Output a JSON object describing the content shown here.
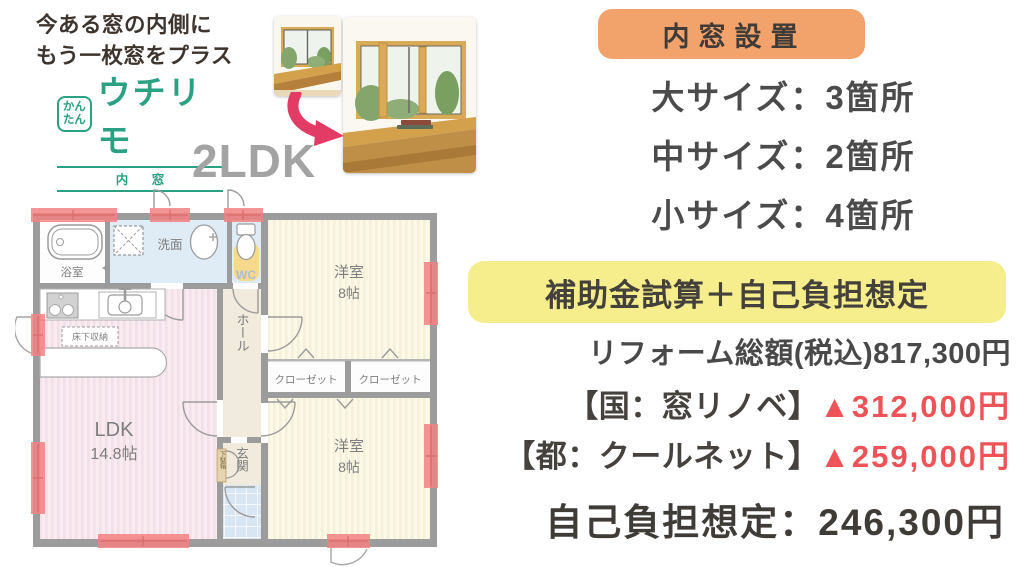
{
  "header": {
    "tagline_line1": "今ある窓の内側に",
    "tagline_line2": "もう一枚窓をプラス",
    "logo": {
      "kantan": "かんたん",
      "brand": "ウチリモ",
      "sub": "内 窓"
    },
    "plan_type": "2LDK"
  },
  "summary": {
    "badge": "内窓設置",
    "sizes": [
      {
        "label": "大サイズ：3箇所"
      },
      {
        "label": "中サイズ：2箇所"
      },
      {
        "label": "小サイズ：4箇所"
      }
    ],
    "subsidy_badge": "補助金試算＋自己負担想定",
    "total_line": "リフォーム総額(税込)817,300円",
    "subsidies": [
      {
        "label": "【国：窓リノベ】",
        "amount": "▲312,000円"
      },
      {
        "label": "【都：クールネット】",
        "amount": "▲259,000円"
      }
    ],
    "self_pay_line": "自己負担想定：246,300円"
  },
  "floorplan": {
    "bath": "浴室",
    "washroom": "洗面",
    "wc": "WC",
    "hall": "ホール",
    "genkan": "玄関",
    "shoebox": "下駄箱",
    "floor_storage": "床下収納",
    "ldk_name": "LDK",
    "ldk_size": "14.8帖",
    "room1_name": "洋室",
    "room1_size": "8帖",
    "room2_name": "洋室",
    "room2_size": "8帖",
    "closet1": "クローゼット",
    "closet2": "クローゼット"
  },
  "colors": {
    "accent_orange": "#f2a36c",
    "accent_yellow": "#f6ee8d",
    "price_red": "#ee5457",
    "text_dark": "#454545",
    "brand_green": "#2aa183",
    "plan_gray": "#a3a3a3",
    "wall_gray": "#9c9c9c",
    "window_red": "#f28181",
    "ldk_pink": "#f9ecf1",
    "room_cream": "#fcf9e8",
    "wet_blue": "#dfebf5",
    "hall_beige": "#f0ebdd",
    "tile_blue": "#d8e5f3",
    "arrow_pink": "#e23c66"
  }
}
